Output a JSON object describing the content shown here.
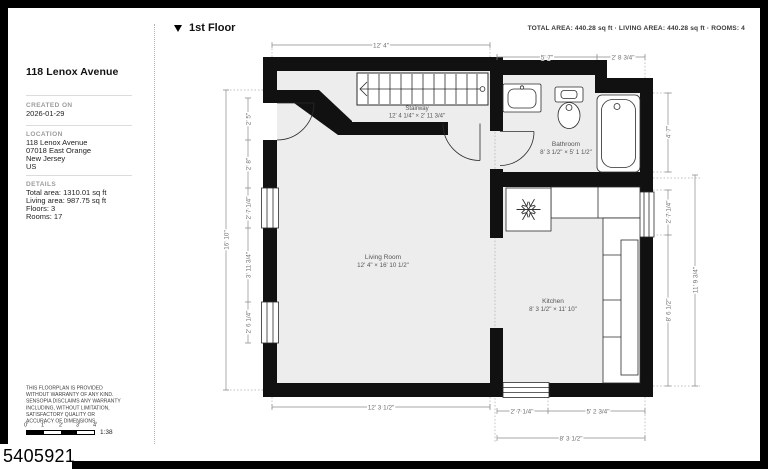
{
  "page": {
    "id_number": "5405921"
  },
  "header": {
    "floor_label": "1st Floor",
    "summary": "TOTAL AREA: 440.28 sq ft · LIVING AREA: 440.28 sq ft · ROOMS: 4"
  },
  "sidebar": {
    "title": "118 Lenox Avenue",
    "created": {
      "heading": "CREATED ON",
      "date": "2026-01-29"
    },
    "location": {
      "heading": "LOCATION",
      "lines": [
        "118 Lenox Avenue",
        "07018 East Orange",
        "New Jersey",
        "US"
      ]
    },
    "details": {
      "heading": "DETAILS",
      "lines": [
        "Total area: 1310.01 sq ft",
        "Living area: 987.75 sq ft",
        "Floors: 3",
        "Rooms: 17"
      ]
    },
    "disclaimer": "THIS FLOORPLAN IS PROVIDED WITHOUT WARRANTY OF ANY KIND. SENSOPIA DISCLAIMS ANY WARRANTY INCLUDING, WITHOUT LIMITATION, SATISFACTORY QUALITY OR ACCURACY OF DIMENSIONS.",
    "scale_bar": {
      "tick_labels": [
        "0'",
        "1'",
        "2'",
        "3'",
        "4'"
      ],
      "ratio": "1:38"
    }
  },
  "plan": {
    "rooms": {
      "stairway": {
        "name": "Stairway",
        "size": "12' 4 1/4\" × 2' 11 3/4\""
      },
      "bathroom": {
        "name": "Bathroom",
        "size": "8' 3 1/2\" × 5' 1 1/2\""
      },
      "living_room": {
        "name": "Living Room",
        "size": "12' 4\" × 16' 10 1/2\""
      },
      "kitchen": {
        "name": "Kitchen",
        "size": "8' 3 1/2\" × 11' 10\""
      }
    },
    "dims": {
      "top_main": "12' 4\"",
      "top_bath_left": "5' 7\"",
      "top_bath_right": "2' 8 3/4\"",
      "left_1": "2' 5\"",
      "left_2": "2' 8\"",
      "left_3": "2' 7 1/4\"",
      "left_4": "3' 11 3/4\"",
      "left_5": "2' 6 1/4\"",
      "left_total": "16' 10\"",
      "right_1": "4' 7\"",
      "right_2": "2' 7 1/4\"",
      "right_3": "8' 6 1/2\"",
      "right_total": "11' 9 3/4\"",
      "bottom_1": "12' 3 1/2\"",
      "bottom_2": "2' 7 1/4\"",
      "bottom_3": "5' 2 3/4\"",
      "bottom_total": "8' 3 1/2\""
    },
    "colors": {
      "wall": "#111111",
      "floor": "#ededed",
      "dimension": "#6d6d6d"
    }
  }
}
